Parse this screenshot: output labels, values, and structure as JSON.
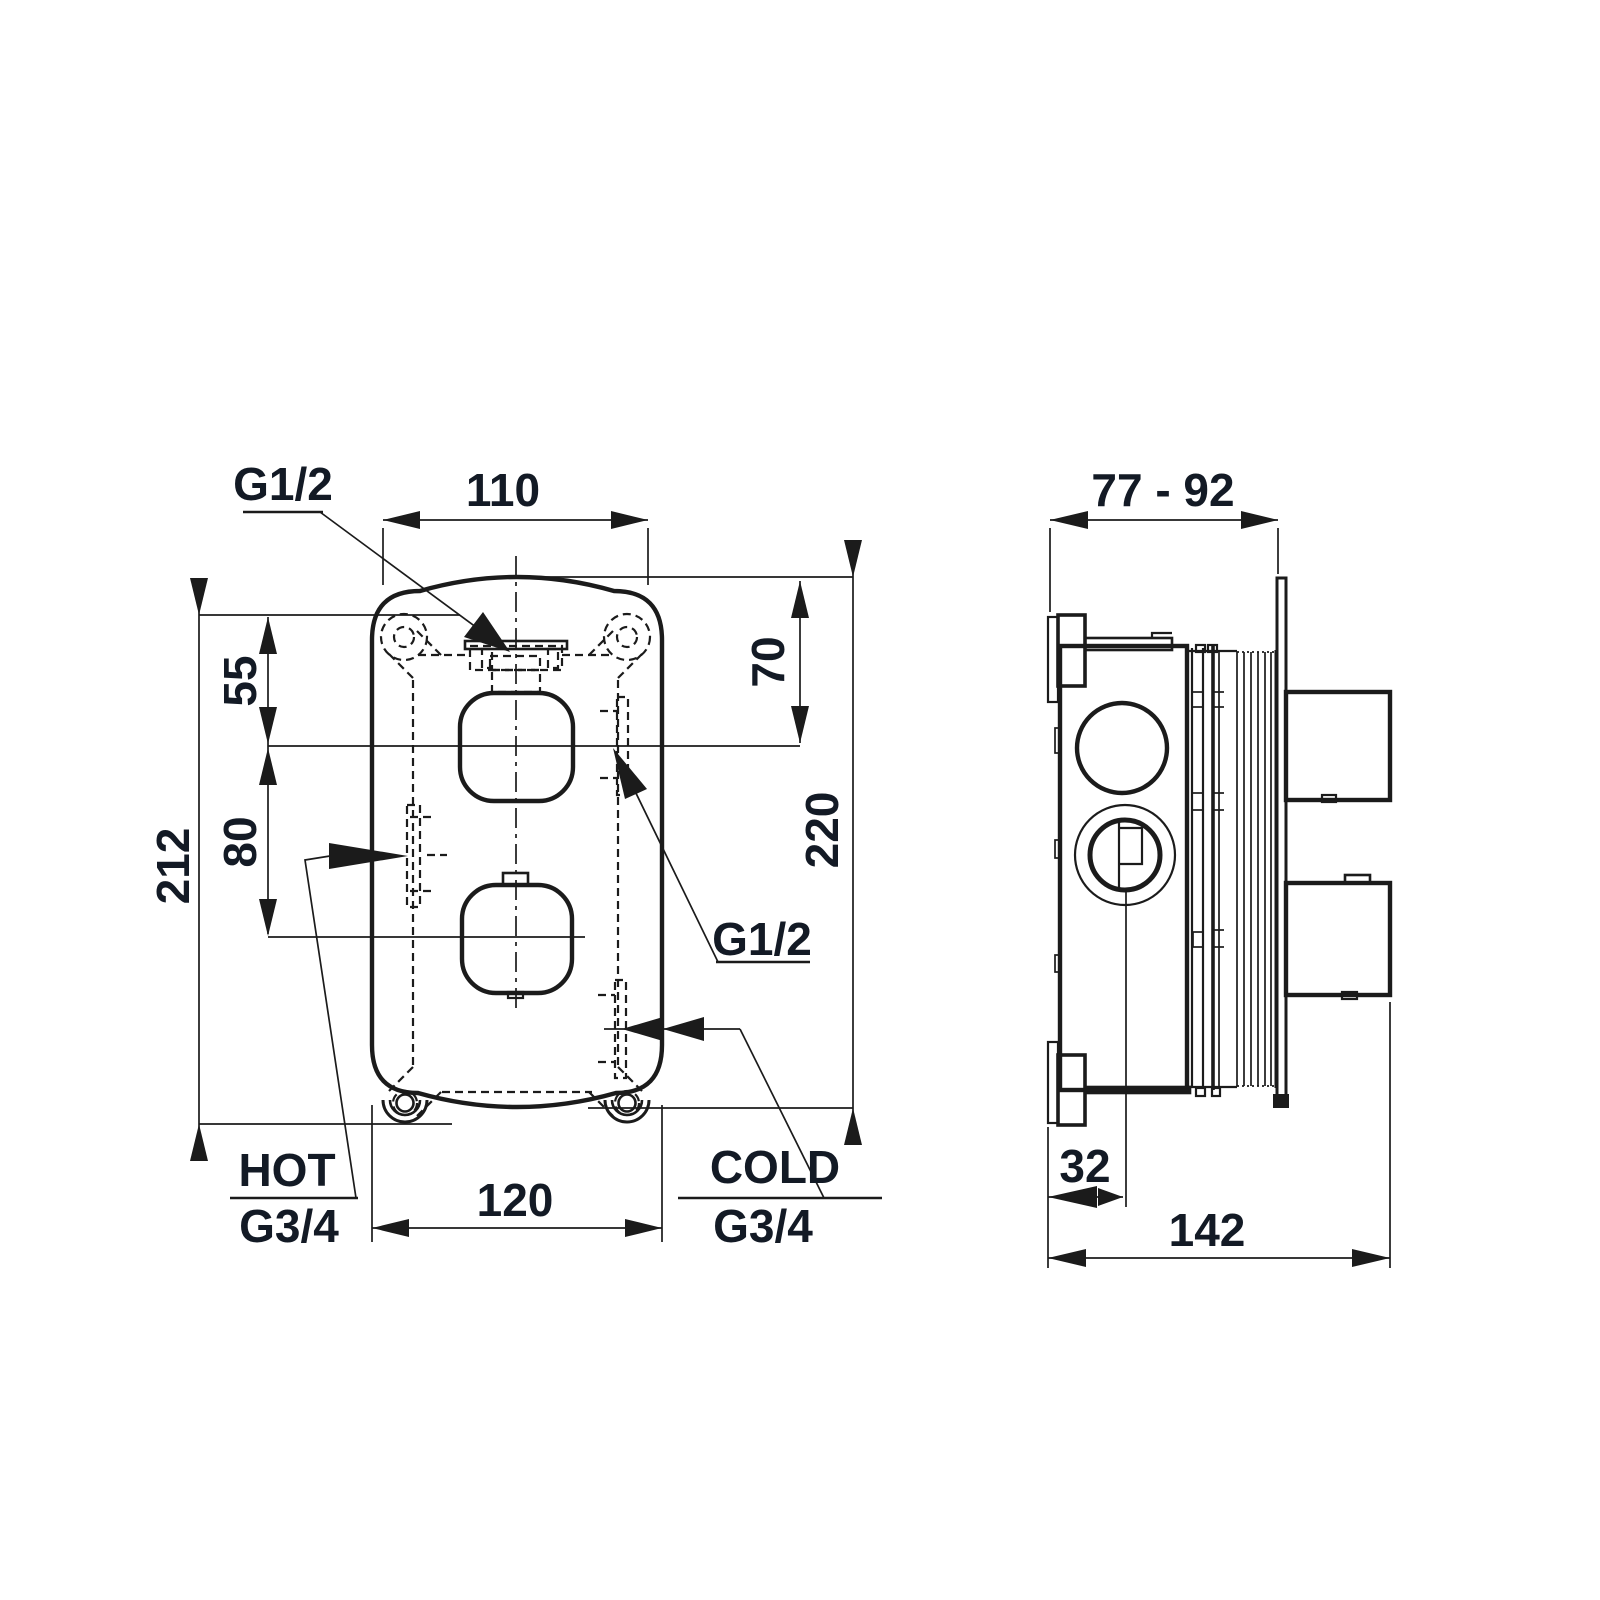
{
  "front": {
    "dim_width_top": "110",
    "dim_width_bottom": "120",
    "dim_height_left": "212",
    "dim_height_right": "220",
    "dim_top_offset": "70",
    "dim_hole_top": "55",
    "dim_hole_spacing": "80",
    "label_outlet_top": "G1/2",
    "label_outlet_right": "G1/2",
    "label_hot": "HOT",
    "label_hot_thread": "G3/4",
    "label_cold": "COLD",
    "label_cold_thread": "G3/4"
  },
  "side": {
    "dim_depth_range": "77 - 92",
    "dim_center_offset": "32",
    "dim_total_depth": "142"
  },
  "colors": {
    "line": "#1b1b1b",
    "text": "#131a25",
    "bg": "#ffffff"
  }
}
